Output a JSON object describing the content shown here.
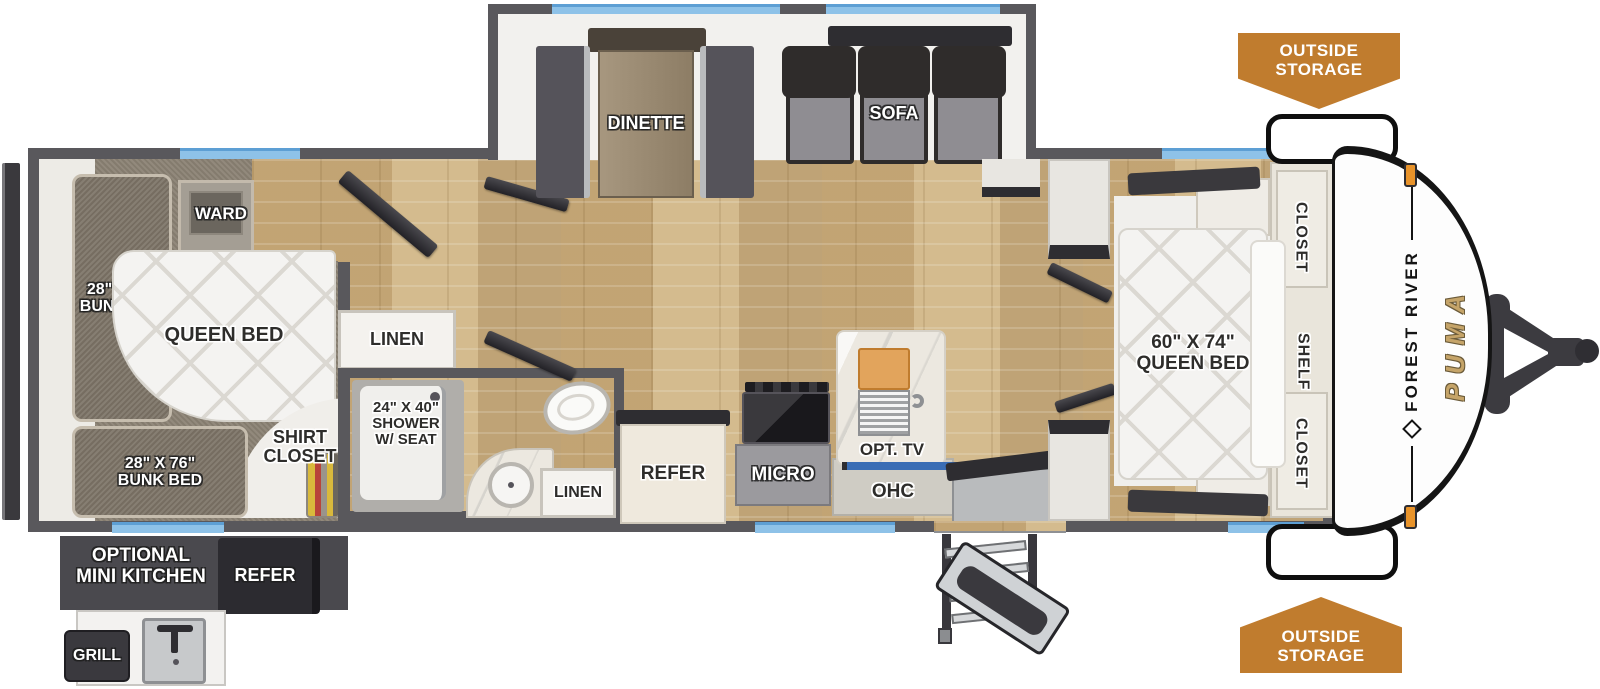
{
  "plan": {
    "brand": "FOREST RIVER",
    "model": "PUMA",
    "badge_top": "OUTSIDE\nSTORAGE",
    "badge_bottom": "OUTSIDE\nSTORAGE",
    "rear_bedroom": {
      "bunk_top": "28\" X 65\"\nBUNK BED",
      "ward": "WARD",
      "queen": "QUEEN BED",
      "shirt_closet": "SHIRT\nCLOSET",
      "bunk_bottom": "28\" X 76\"\nBUNK BED"
    },
    "bath": {
      "linen_top": "LINEN",
      "shower": "24\" X 40\"\nSHOWER\nW/ SEAT",
      "linen_bottom": "LINEN"
    },
    "kitchen": {
      "refer": "REFER",
      "micro": "MICRO",
      "opt_tv": "OPT. TV",
      "ohc": "OHC"
    },
    "living": {
      "dinette": "DINETTE",
      "sofa": "SOFA"
    },
    "front_bedroom": {
      "queen": "60\" X 74\"\nQUEEN BED",
      "closet_top": "CLOSET",
      "shelf": "SHELF",
      "closet_bottom": "CLOSET"
    },
    "outdoor": {
      "mini_kitchen": "OPTIONAL\nMINI KITCHEN",
      "refer": "REFER",
      "grill": "GRILL"
    },
    "colors": {
      "badge_orange": "#c07c2e",
      "wall_gray": "#59585c",
      "window_blue": "#8ec2e8",
      "floor_wood": "#ccb286",
      "puma_gold": "#c5a469",
      "tv_blue": "#3a6db5",
      "marker_orange": "#e8932a"
    }
  }
}
